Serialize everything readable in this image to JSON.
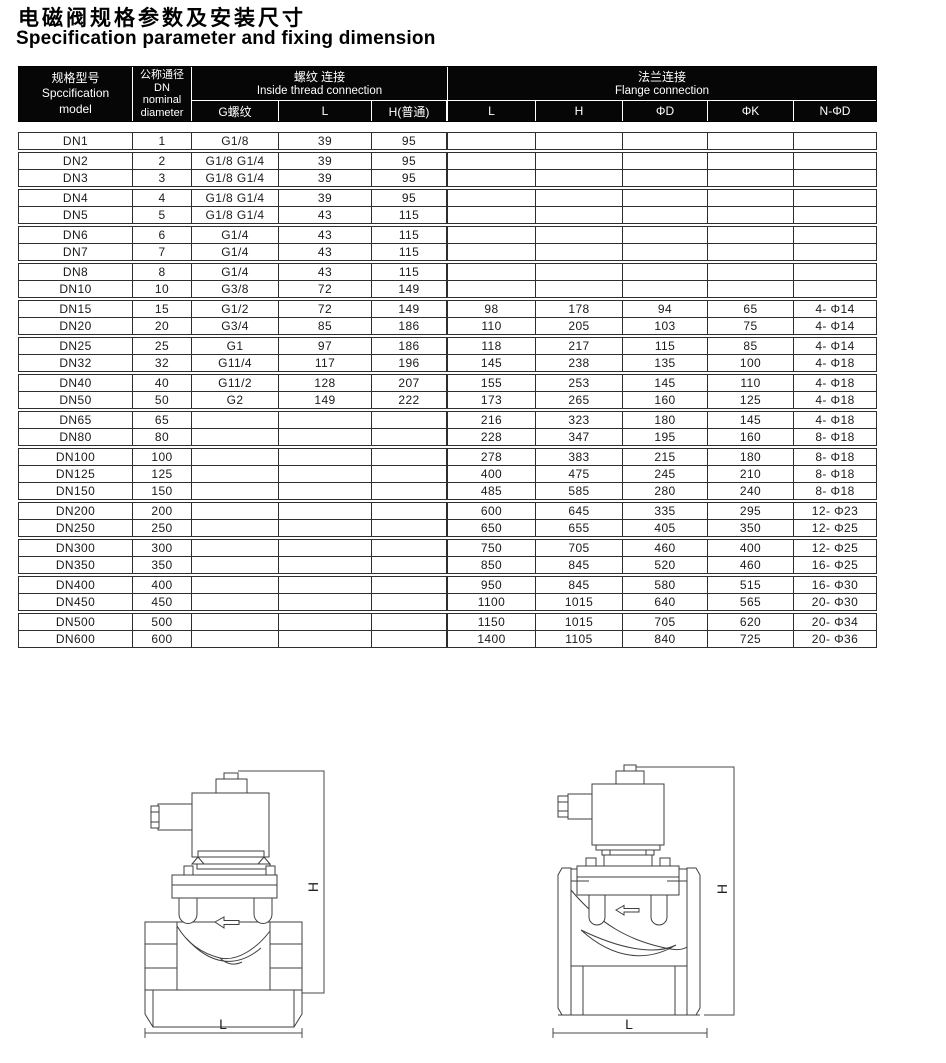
{
  "header": {
    "title_cn": "电磁阀规格参数及安装尺寸",
    "title_en": "Specification parameter and fixing dimension"
  },
  "colors": {
    "header_bg": "#060606",
    "header_text": "#ffffff",
    "grid_line": "#2e2e2e",
    "drawing_line": "#3f3f3f"
  },
  "table": {
    "head": {
      "model_lines": [
        "规格型号",
        "Spccification",
        "model"
      ],
      "dn_lines": [
        "公称通径",
        "DN",
        "nominal",
        "diameter"
      ],
      "thread": {
        "cn": "螺纹 连接",
        "en": "Inside thread connection",
        "subs": [
          "G螺纹",
          "L",
          "H(普通)"
        ]
      },
      "flange": {
        "cn": "法兰连接",
        "en": "Flange connection",
        "subs": [
          "L",
          "H",
          "ΦD",
          "ΦK",
          "N-ΦD"
        ]
      }
    },
    "rows": [
      {
        "model": "DN1",
        "dn": "1",
        "g": "G1/8",
        "tl": "39",
        "th": "95",
        "fl": "",
        "fh": "",
        "fd": "",
        "fk": "",
        "fnd": ""
      },
      {
        "model": "DN2",
        "dn": "2",
        "g": "G1/8 G1/4",
        "tl": "39",
        "th": "95",
        "fl": "",
        "fh": "",
        "fd": "",
        "fk": "",
        "fnd": ""
      },
      {
        "model": "DN3",
        "dn": "3",
        "g": "G1/8 G1/4",
        "tl": "39",
        "th": "95",
        "fl": "",
        "fh": "",
        "fd": "",
        "fk": "",
        "fnd": ""
      },
      {
        "model": "DN4",
        "dn": "4",
        "g": "G1/8 G1/4",
        "tl": "39",
        "th": "95",
        "fl": "",
        "fh": "",
        "fd": "",
        "fk": "",
        "fnd": ""
      },
      {
        "model": "DN5",
        "dn": "5",
        "g": "G1/8 G1/4",
        "tl": "43",
        "th": "115",
        "fl": "",
        "fh": "",
        "fd": "",
        "fk": "",
        "fnd": ""
      },
      {
        "model": "DN6",
        "dn": "6",
        "g": "G1/4",
        "tl": "43",
        "th": "115",
        "fl": "",
        "fh": "",
        "fd": "",
        "fk": "",
        "fnd": ""
      },
      {
        "model": "DN7",
        "dn": "7",
        "g": "G1/4",
        "tl": "43",
        "th": "115",
        "fl": "",
        "fh": "",
        "fd": "",
        "fk": "",
        "fnd": ""
      },
      {
        "model": "DN8",
        "dn": "8",
        "g": "G1/4",
        "tl": "43",
        "th": "115",
        "fl": "",
        "fh": "",
        "fd": "",
        "fk": "",
        "fnd": ""
      },
      {
        "model": "DN10",
        "dn": "10",
        "g": "G3/8",
        "tl": "72",
        "th": "149",
        "fl": "",
        "fh": "",
        "fd": "",
        "fk": "",
        "fnd": ""
      },
      {
        "model": "DN15",
        "dn": "15",
        "g": "G1/2",
        "tl": "72",
        "th": "149",
        "fl": "98",
        "fh": "178",
        "fd": "94",
        "fk": "65",
        "fnd": "4- Φ14"
      },
      {
        "model": "DN20",
        "dn": "20",
        "g": "G3/4",
        "tl": "85",
        "th": "186",
        "fl": "110",
        "fh": "205",
        "fd": "103",
        "fk": "75",
        "fnd": "4- Φ14"
      },
      {
        "model": "DN25",
        "dn": "25",
        "g": "G1",
        "tl": "97",
        "th": "186",
        "fl": "118",
        "fh": "217",
        "fd": "115",
        "fk": "85",
        "fnd": "4- Φ14"
      },
      {
        "model": "DN32",
        "dn": "32",
        "g": "G11/4",
        "tl": "117",
        "th": "196",
        "fl": "145",
        "fh": "238",
        "fd": "135",
        "fk": "100",
        "fnd": "4- Φ18"
      },
      {
        "model": "DN40",
        "dn": "40",
        "g": "G11/2",
        "tl": "128",
        "th": "207",
        "fl": "155",
        "fh": "253",
        "fd": "145",
        "fk": "110",
        "fnd": "4- Φ18"
      },
      {
        "model": "DN50",
        "dn": "50",
        "g": "G2",
        "tl": "149",
        "th": "222",
        "fl": "173",
        "fh": "265",
        "fd": "160",
        "fk": "125",
        "fnd": "4- Φ18"
      },
      {
        "model": "DN65",
        "dn": "65",
        "g": "",
        "tl": "",
        "th": "",
        "fl": "216",
        "fh": "323",
        "fd": "180",
        "fk": "145",
        "fnd": "4- Φ18"
      },
      {
        "model": "DN80",
        "dn": "80",
        "g": "",
        "tl": "",
        "th": "",
        "fl": "228",
        "fh": "347",
        "fd": "195",
        "fk": "160",
        "fnd": "8- Φ18"
      },
      {
        "model": "DN100",
        "dn": "100",
        "g": "",
        "tl": "",
        "th": "",
        "fl": "278",
        "fh": "383",
        "fd": "215",
        "fk": "180",
        "fnd": "8- Φ18"
      },
      {
        "model": "DN125",
        "dn": "125",
        "g": "",
        "tl": "",
        "th": "",
        "fl": "400",
        "fh": "475",
        "fd": "245",
        "fk": "210",
        "fnd": "8- Φ18"
      },
      {
        "model": "DN150",
        "dn": "150",
        "g": "",
        "tl": "",
        "th": "",
        "fl": "485",
        "fh": "585",
        "fd": "280",
        "fk": "240",
        "fnd": "8- Φ18"
      },
      {
        "model": "DN200",
        "dn": "200",
        "g": "",
        "tl": "",
        "th": "",
        "fl": "600",
        "fh": "645",
        "fd": "335",
        "fk": "295",
        "fnd": "12- Φ23"
      },
      {
        "model": "DN250",
        "dn": "250",
        "g": "",
        "tl": "",
        "th": "",
        "fl": "650",
        "fh": "655",
        "fd": "405",
        "fk": "350",
        "fnd": "12- Φ25"
      },
      {
        "model": "DN300",
        "dn": "300",
        "g": "",
        "tl": "",
        "th": "",
        "fl": "750",
        "fh": "705",
        "fd": "460",
        "fk": "400",
        "fnd": "12- Φ25"
      },
      {
        "model": "DN350",
        "dn": "350",
        "g": "",
        "tl": "",
        "th": "",
        "fl": "850",
        "fh": "845",
        "fd": "520",
        "fk": "460",
        "fnd": "16- Φ25"
      },
      {
        "model": "DN400",
        "dn": "400",
        "g": "",
        "tl": "",
        "th": "",
        "fl": "950",
        "fh": "845",
        "fd": "580",
        "fk": "515",
        "fnd": "16- Φ30"
      },
      {
        "model": "DN450",
        "dn": "450",
        "g": "",
        "tl": "",
        "th": "",
        "fl": "1100",
        "fh": "1015",
        "fd": "640",
        "fk": "565",
        "fnd": "20- Φ30"
      },
      {
        "model": "DN500",
        "dn": "500",
        "g": "",
        "tl": "",
        "th": "",
        "fl": "1150",
        "fh": "1015",
        "fd": "705",
        "fk": "620",
        "fnd": "20- Φ34"
      },
      {
        "model": "DN600",
        "dn": "600",
        "g": "",
        "tl": "",
        "th": "",
        "fl": "1400",
        "fh": "1105",
        "fd": "840",
        "fk": "725",
        "fnd": "20- Φ36"
      }
    ],
    "groups": [
      [
        0
      ],
      [
        1,
        2
      ],
      [
        3,
        4
      ],
      [
        5,
        6
      ],
      [
        7,
        8
      ],
      [
        9,
        10
      ],
      [
        11,
        12
      ],
      [
        13,
        14
      ],
      [
        15,
        16
      ],
      [
        17,
        18,
        19
      ],
      [
        20,
        21
      ],
      [
        22,
        23
      ],
      [
        24,
        25
      ],
      [
        26,
        27
      ]
    ]
  },
  "drawings": {
    "threaded": {
      "h_label": "H",
      "l_label": "L"
    },
    "flanged": {
      "h_label": "H",
      "l_label": "L"
    }
  }
}
